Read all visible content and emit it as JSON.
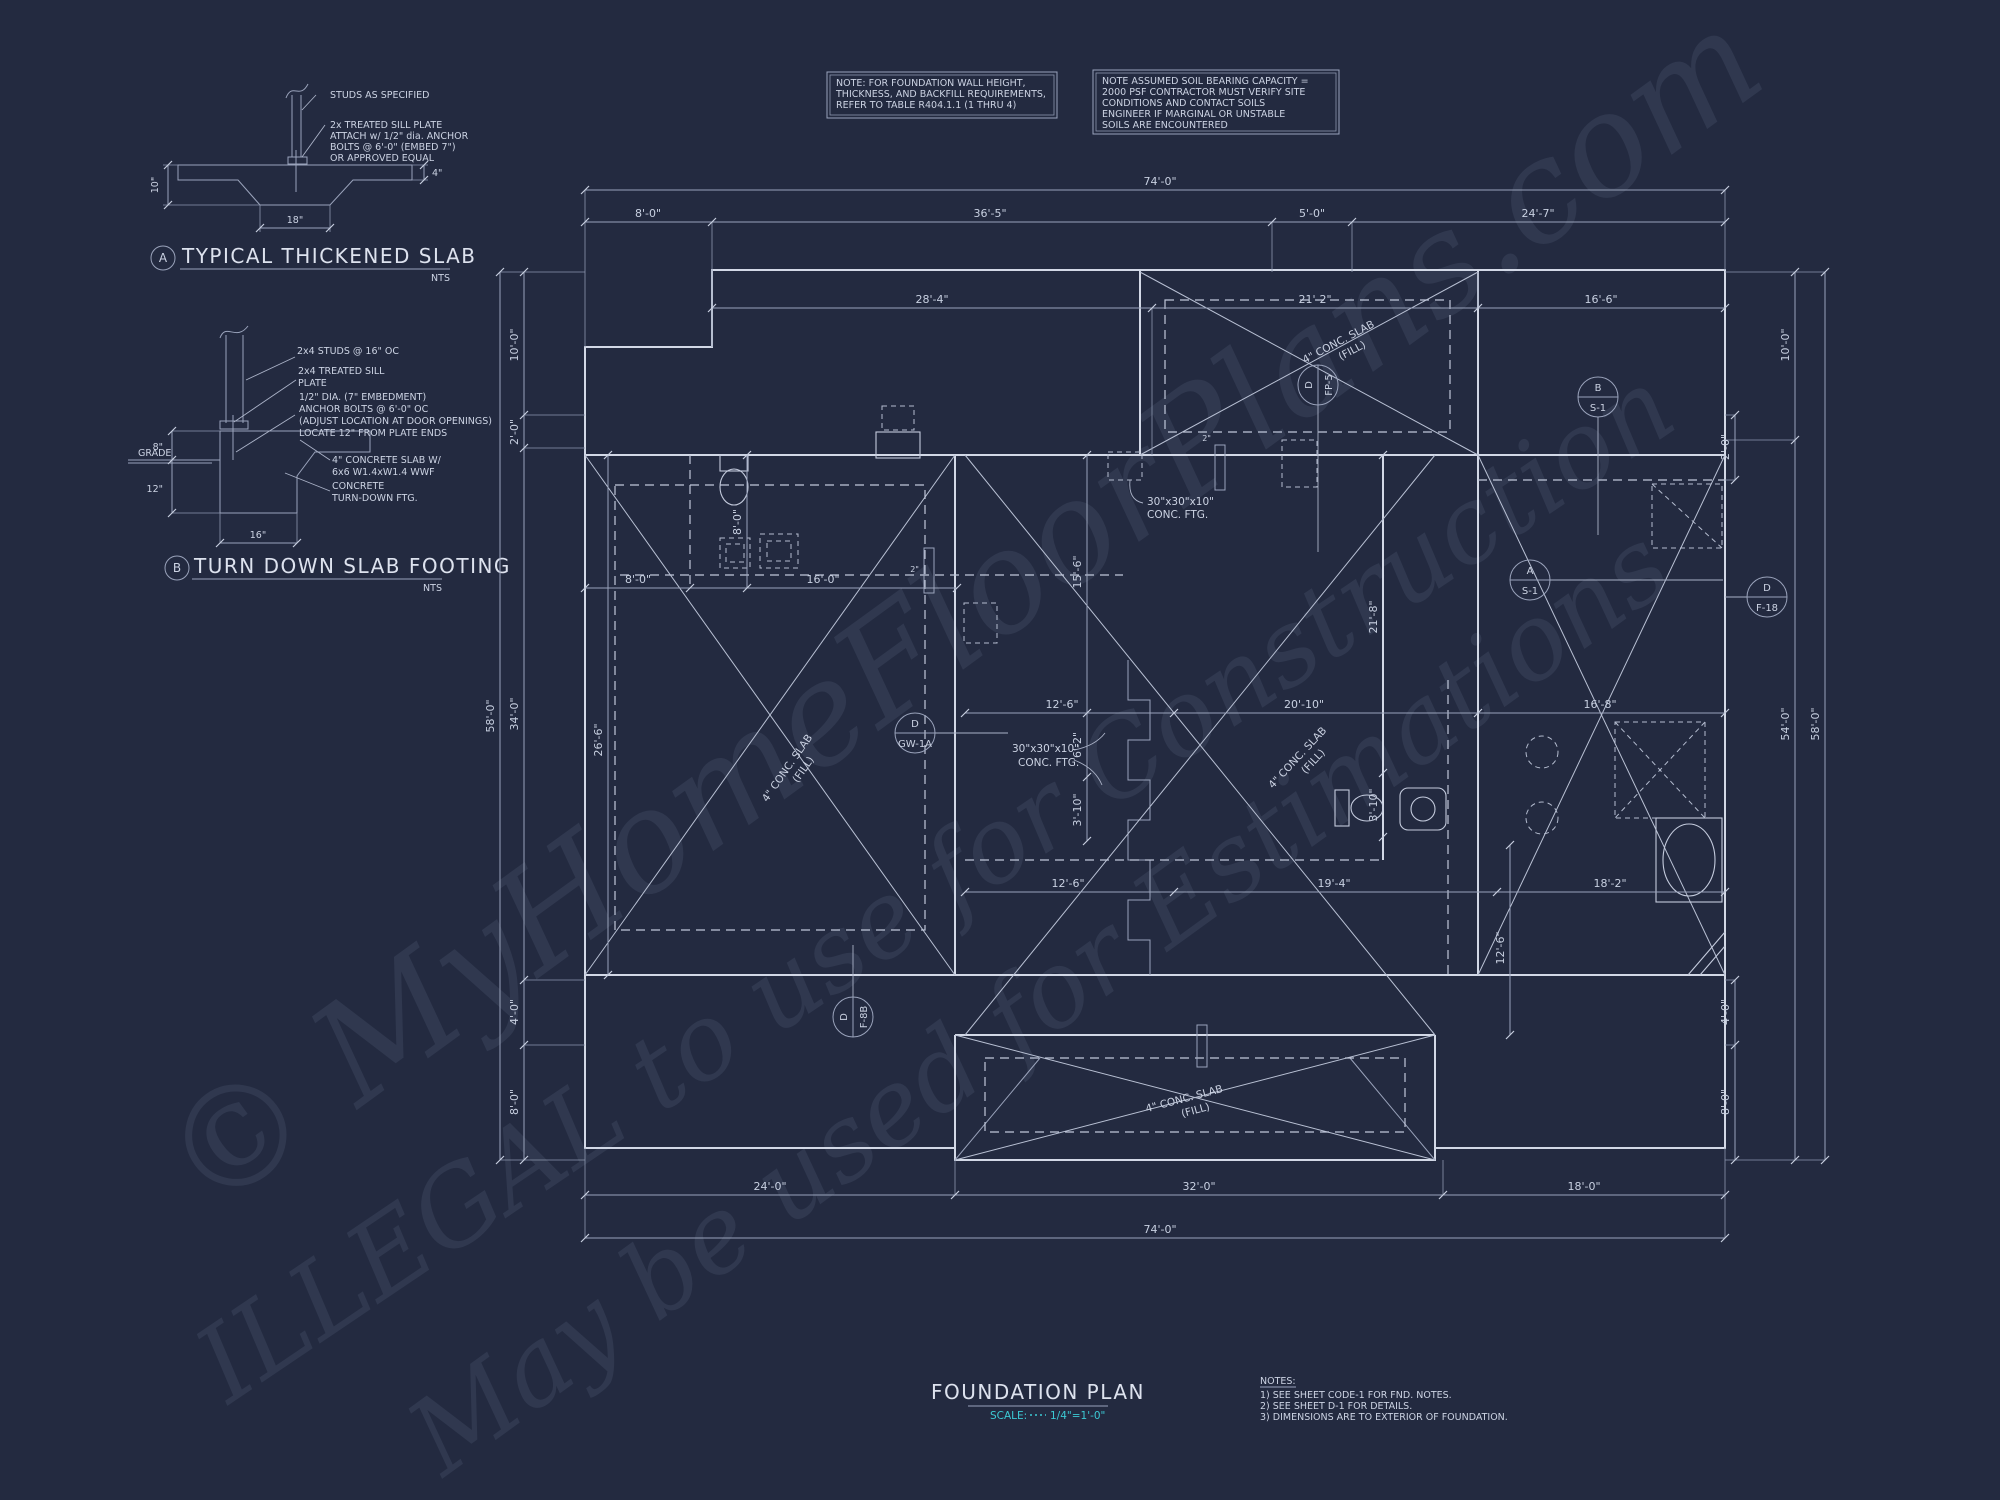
{
  "colors": {
    "background": "#232a40",
    "ink": "#ccd3e3",
    "dim_ink": "#c8d0e1",
    "accent_cyan": "#3cc9d4",
    "watermark": "#aab6d6"
  },
  "watermark": {
    "line1": "© MyHomeFloorPlans.com",
    "line2": "ILLEGAL to use for Construction",
    "line3": "May be used for Estimations"
  },
  "note_box_1": {
    "lines": [
      "NOTE: FOR FOUNDATION WALL HEIGHT,",
      "THICKNESS, AND BACKFILL REQUIREMENTS,",
      "REFER TO TABLE R404.1.1 (1 THRU 4)"
    ]
  },
  "note_box_2": {
    "lines": [
      "NOTE ASSUMED SOIL BEARING CAPACITY =",
      "2000 PSF CONTRACTOR MUST VERIFY SITE",
      "CONDITIONS AND CONTACT SOILS",
      "ENGINEER IF MARGINAL OR UNSTABLE",
      "SOILS ARE ENCOUNTERED"
    ]
  },
  "detail_a": {
    "bubble": "A",
    "title": "TYPICAL THICKENED SLAB",
    "scale": "NTS",
    "label_studs": "STUDS AS SPECIFIED",
    "label_sill": [
      "2x TREATED SILL PLATE",
      "ATTACH w/ 1/2\" dia. ANCHOR",
      "BOLTS @ 6'-0\" (EMBED 7\")",
      "OR APPROVED EQUAL"
    ],
    "dim_depth": "10\"",
    "dim_width": "18\"",
    "dim_slab": "4\""
  },
  "detail_b": {
    "bubble": "B",
    "title": "TURN DOWN SLAB FOOTING",
    "scale": "NTS",
    "label_studs": "2x4 STUDS @ 16\" OC",
    "label_sill": [
      "2x4 TREATED SILL",
      "PLATE"
    ],
    "label_bolts": [
      "1/2\" DIA. (7\" EMBEDMENT)",
      "ANCHOR BOLTS @ 6'-0\" OC",
      "(ADJUST LOCATION AT DOOR OPENINGS)",
      "LOCATE 12\" FROM PLATE ENDS"
    ],
    "label_grade": "GRADE",
    "label_slab": [
      "4\" CONCRETE SLAB W/",
      "6x6 W1.4xW1.4 WWF"
    ],
    "label_turndown": [
      "CONCRETE",
      "TURN-DOWN FTG."
    ],
    "dim_above": "8\"",
    "dim_below": "12\"",
    "dim_width": "16\""
  },
  "plan": {
    "dims": {
      "top_74": "74'-0\"",
      "top_8": "8'-0\"",
      "top_36_5": "36'-5\"",
      "top_5": "5'-0\"",
      "top_24_7": "24'-7\"",
      "row_28_4": "28'-4\"",
      "row_21_2": "21'-2\"",
      "row_16_6": "16'-6\"",
      "left_10": "10'-0\"",
      "left_2": "2'-0\"",
      "left_58": "58'-0\"",
      "left_34": "34'-0\"",
      "left_4": "4'-0\"",
      "left_8": "8'-0\"",
      "right_10": "10'-0\"",
      "right_2": "2'-0\"",
      "right_54": "54'-0\"",
      "right_58": "58'-0\"",
      "right_4": "4'-0\"",
      "right_8": "8'-0\"",
      "bot_24": "24'-0\"",
      "bot_32": "32'-0\"",
      "bot_18": "18'-0\"",
      "bot_74": "74'-0\"",
      "gar_8": "8'-0\"",
      "gar_16": "16'-0\"",
      "gar_8v": "8'-0\"",
      "gar_26_6": "26'-6\"",
      "mid_12_6": "12'-6\"",
      "mid_20_10": "20'-10\"",
      "mid_16_8": "16'-8\"",
      "mid_15_6": "15'-6\"",
      "mid_6_2": "6'-2\"",
      "mid_3_10": "3'-10\"",
      "low_12_6": "12'-6\"",
      "low_19_4": "19'-4\"",
      "low_18_2": "18'-2\"",
      "low_12_6v": "12'-6\"",
      "right_21_8": "21'-8\"",
      "right_3_10": "3'-10\"",
      "pier_2a": "2\"",
      "pier_2b": "2\""
    },
    "slab_label": {
      "l1": "4\" CONC. SLAB",
      "l2": "(FILL)"
    },
    "ftg_label": {
      "l1": "30\"x30\"x10\"",
      "l2": "CONC. FTG."
    },
    "callouts": [
      {
        "letter": "D",
        "sheet": "FP-5"
      },
      {
        "letter": "B",
        "sheet": "S-1"
      },
      {
        "letter": "A",
        "sheet": "S-1"
      },
      {
        "letter": "D",
        "sheet": "F-18"
      },
      {
        "letter": "D",
        "sheet": "GW-1A"
      },
      {
        "letter": "D",
        "sheet": "F-8B"
      }
    ]
  },
  "titleblock": {
    "title": "FOUNDATION PLAN",
    "scale_label": "SCALE:",
    "scale_value": "1/4\"=1'-0\"",
    "notes_title": "NOTES:",
    "notes": [
      "1) SEE SHEET CODE-1 FOR FND. NOTES.",
      "2) SEE SHEET D-1 FOR DETAILS.",
      "3) DIMENSIONS ARE TO EXTERIOR OF FOUNDATION."
    ]
  }
}
